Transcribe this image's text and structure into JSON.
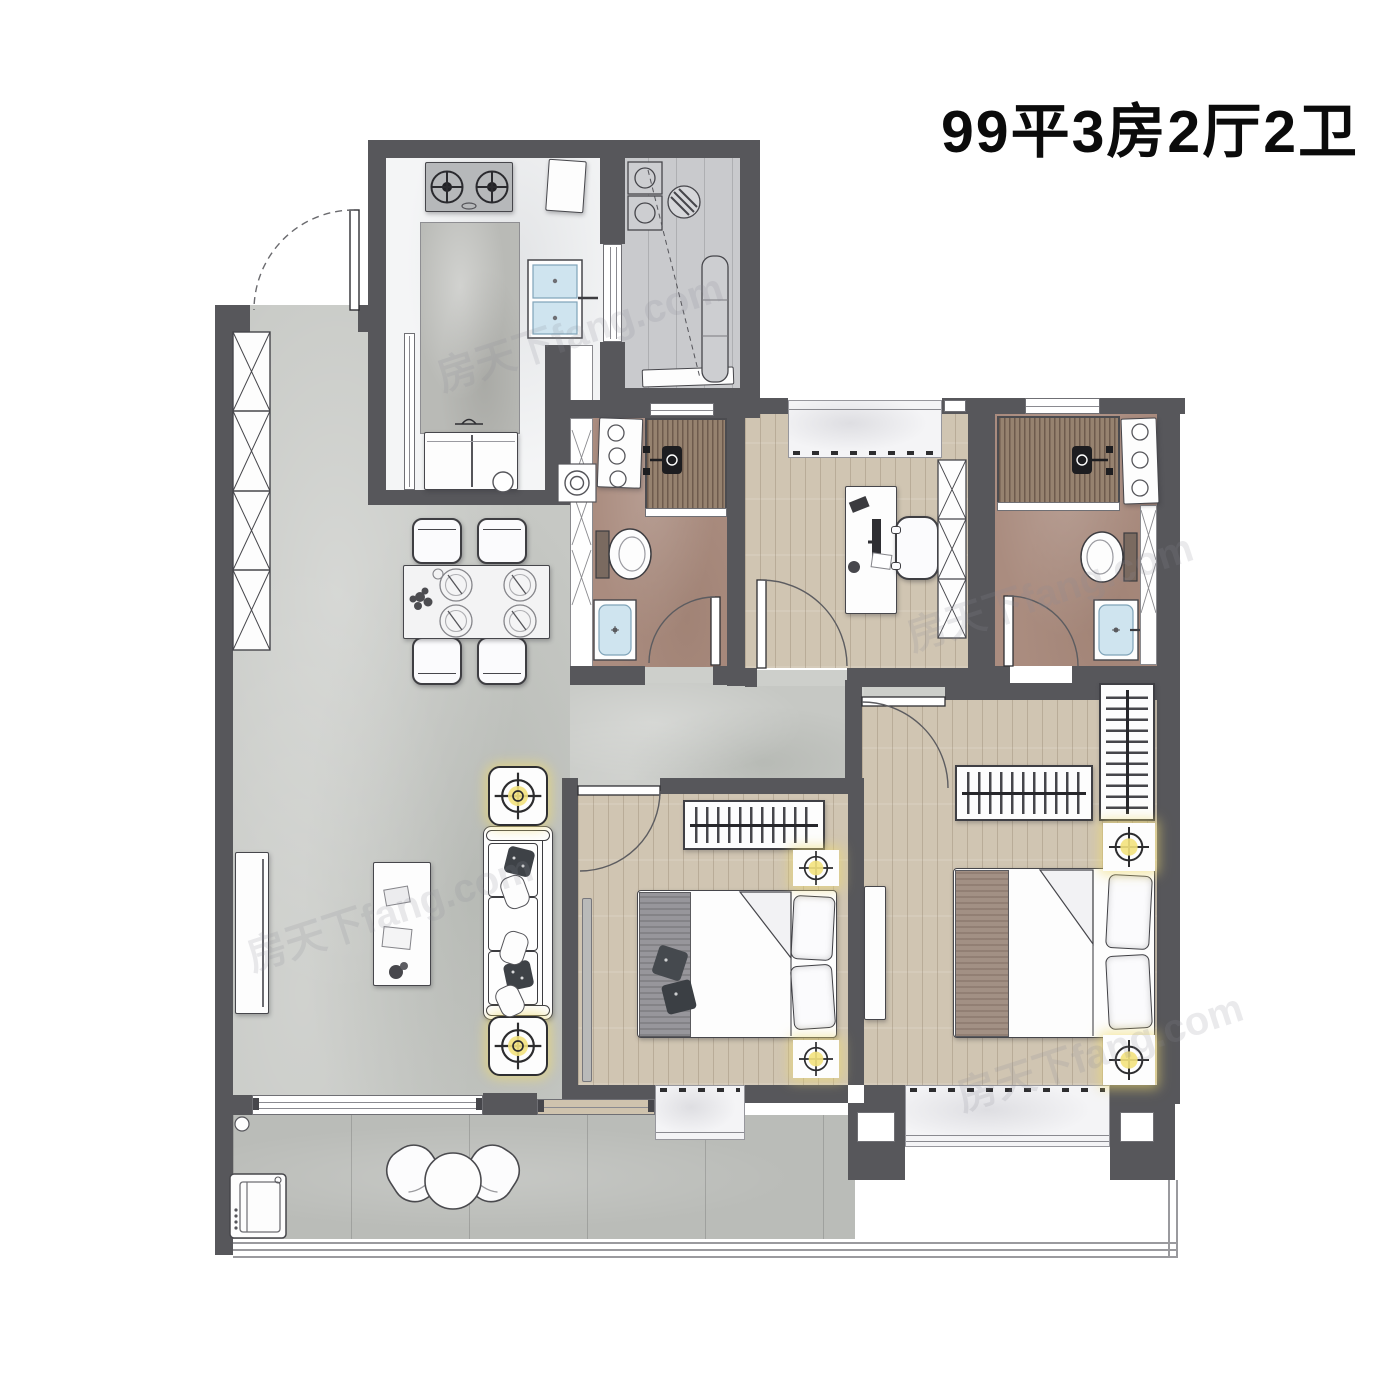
{
  "title": "99平3房2厅2卫",
  "watermark": "房天下fang.com",
  "colors": {
    "wall": "#57575b",
    "living_floor": "#c6c8c4",
    "wood_floor": "#d0c5b2",
    "bath_floor": "#aa8c7f",
    "shower_slats": "#96826f",
    "balcony_floor": "#babcb8",
    "kitchen_floor": "#f4f5f6",
    "utility_floor": "#c9cacd",
    "counter": "#b9bab6",
    "sink_basin": "#cfe4ef",
    "lamp_glow": "#f3e27d",
    "window_sill": "#f4f4f6",
    "title_text": "#0b0b0b"
  }
}
